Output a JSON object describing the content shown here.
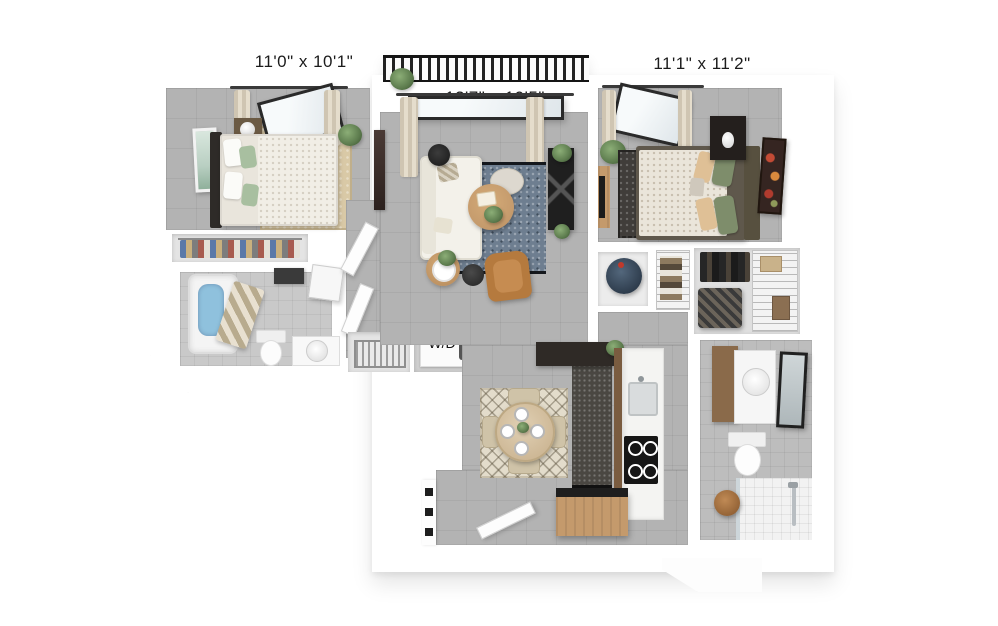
{
  "floor_plan": {
    "rooms": {
      "bedroom_1": {
        "dimensions": "11'0\" x 10'1\""
      },
      "living_room": {
        "dimensions": "13'7\" x 10'5\""
      },
      "bedroom_2": {
        "dimensions": "11'1\" x 11'2\""
      },
      "laundry_closet": {
        "appliance_label": "W/D"
      }
    },
    "colors": {
      "wall": "#ffffff",
      "floor_tile": "#b3b3b3",
      "bath_tile": "#c9c9c9",
      "living_rug": "#6e7e90",
      "dining_rug": "#e3dccb",
      "bedroom1_rug": "#d9c9a6",
      "bedroom2_rug": "#403d3a",
      "wood": "#c49a6c",
      "leather": "#b57a3e",
      "water": "#8fc1dd",
      "plant": "#5d7c4e",
      "railing": "#222222",
      "label_text": "#1c1c1c"
    }
  }
}
